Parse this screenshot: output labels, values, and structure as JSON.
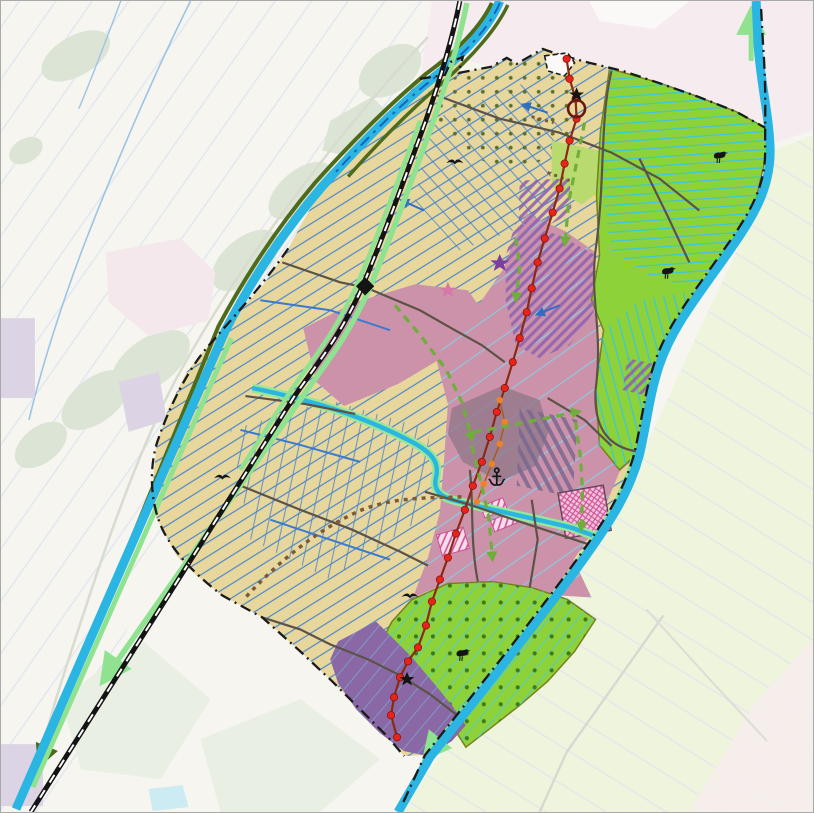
{
  "map": {
    "kind": "land-use-planning-map",
    "colors": {
      "bg_base": "#f6f5f0",
      "bg_pink": "#f6ecef",
      "bg_green_se": "#eff4dd",
      "wood": "#dce4d6",
      "lavender": "#dcd3e4",
      "pale_pink_patch": "#f5e8ec",
      "polder_tan": "#e8d79c",
      "grass_lime": "#8ed23a",
      "mixed_pink": "#cb92aa",
      "dev_purple": "#8a68a5",
      "overlay_mauve": "#8f7588",
      "hatch_purple": "#8f63b0",
      "magenta": "#cc4f94",
      "magenta_fill": "#f3c4dc",
      "canal_cyan": "#2ab5e3",
      "canal_edge_olive": "#4e6b1c",
      "canal_edge_lightgreen": "#8fe28f",
      "ditch_blue": "#4a86cc",
      "ditch_blue_bold": "#2f6fc0",
      "ditch_cyan": "#38c4e4",
      "pink_ditch_cyan": "#86cfe6",
      "railway_black": "#141414",
      "boundary_black": "#1a1a1a",
      "water_boundary_blue": "#1565c0",
      "road_dark": "#5c5247",
      "trail_brown": "#7d5a33",
      "route_red": "#e8231a",
      "route_red_line": "#8a2a12",
      "route_orange": "#f08223",
      "route_green": "#6fae3a",
      "dot_olive": "#5a6e2a",
      "dot_green": "#3c7a1c",
      "yellow_green_blob": "#b9da6e",
      "icon_black": "#141414",
      "star_purple": "#7a3fa0",
      "star_pink": "#d878a8",
      "circle_marker_red": "#6b1410"
    },
    "red_route": {
      "points": [
        [
          567,
          58
        ],
        [
          570,
          78
        ],
        [
          576,
          98
        ],
        [
          577,
          118
        ],
        [
          570,
          140
        ],
        [
          565,
          163
        ],
        [
          560,
          188
        ],
        [
          553,
          212
        ],
        [
          545,
          238
        ],
        [
          538,
          262
        ],
        [
          532,
          288
        ],
        [
          527,
          312
        ],
        [
          520,
          338
        ],
        [
          513,
          362
        ],
        [
          505,
          388
        ],
        [
          497,
          412
        ],
        [
          490,
          437
        ],
        [
          482,
          462
        ],
        [
          473,
          486
        ],
        [
          465,
          510
        ],
        [
          456,
          534
        ],
        [
          448,
          558
        ],
        [
          440,
          580
        ],
        [
          432,
          602
        ],
        [
          426,
          626
        ],
        [
          418,
          648
        ],
        [
          408,
          662
        ],
        [
          400,
          678
        ],
        [
          394,
          698
        ],
        [
          391,
          716
        ],
        [
          397,
          738
        ]
      ]
    },
    "orange_route": {
      "points": [
        [
          500,
          400
        ],
        [
          505,
          422
        ],
        [
          500,
          444
        ],
        [
          492,
          464
        ],
        [
          484,
          484
        ],
        [
          477,
          502
        ]
      ]
    },
    "green_routes": [
      {
        "points": [
          [
            585,
            122
          ],
          [
            577,
            162
          ],
          [
            569,
            202
          ],
          [
            566,
            236
          ]
        ]
      },
      {
        "points": [
          [
            395,
            305
          ],
          [
            421,
            336
          ],
          [
            446,
            369
          ],
          [
            462,
            402
          ],
          [
            470,
            432
          ]
        ]
      },
      {
        "points": [
          [
            472,
            446
          ],
          [
            481,
            482
          ],
          [
            489,
            518
          ],
          [
            492,
            552
          ]
        ]
      },
      {
        "points": [
          [
            474,
            432
          ],
          [
            508,
            426
          ],
          [
            542,
            419
          ],
          [
            572,
            413
          ]
        ]
      },
      {
        "points": [
          [
            576,
            422
          ],
          [
            581,
            458
          ],
          [
            583,
            494
          ],
          [
            582,
            522
          ]
        ]
      },
      {
        "points": [
          [
            516,
            238
          ],
          [
            520,
            266
          ],
          [
            517,
            292
          ]
        ]
      }
    ],
    "flow_arrows": [
      {
        "points": [
          [
            548,
            112
          ],
          [
            524,
            104
          ]
        ]
      },
      {
        "points": [
          [
            424,
            210
          ],
          [
            402,
            200
          ]
        ]
      },
      {
        "points": [
          [
            560,
            305
          ],
          [
            538,
            314
          ]
        ]
      }
    ],
    "icons": [
      {
        "type": "star-black",
        "x": 577,
        "y": 94
      },
      {
        "type": "circle-marker",
        "x": 577,
        "y": 108
      },
      {
        "type": "star-purple",
        "x": 500,
        "y": 263
      },
      {
        "type": "star-pink",
        "x": 448,
        "y": 290
      },
      {
        "type": "star-black",
        "x": 407,
        "y": 680
      },
      {
        "type": "station-diamond",
        "x": 365,
        "y": 286
      },
      {
        "type": "anchor",
        "x": 497,
        "y": 477
      },
      {
        "type": "bird-standing",
        "x": 720,
        "y": 157
      },
      {
        "type": "bird-standing",
        "x": 668,
        "y": 273
      },
      {
        "type": "bird-standing",
        "x": 462,
        "y": 656
      },
      {
        "type": "bird-flying",
        "x": 455,
        "y": 162
      },
      {
        "type": "bird-flying",
        "x": 222,
        "y": 478
      },
      {
        "type": "bird-flying",
        "x": 410,
        "y": 597
      }
    ]
  }
}
